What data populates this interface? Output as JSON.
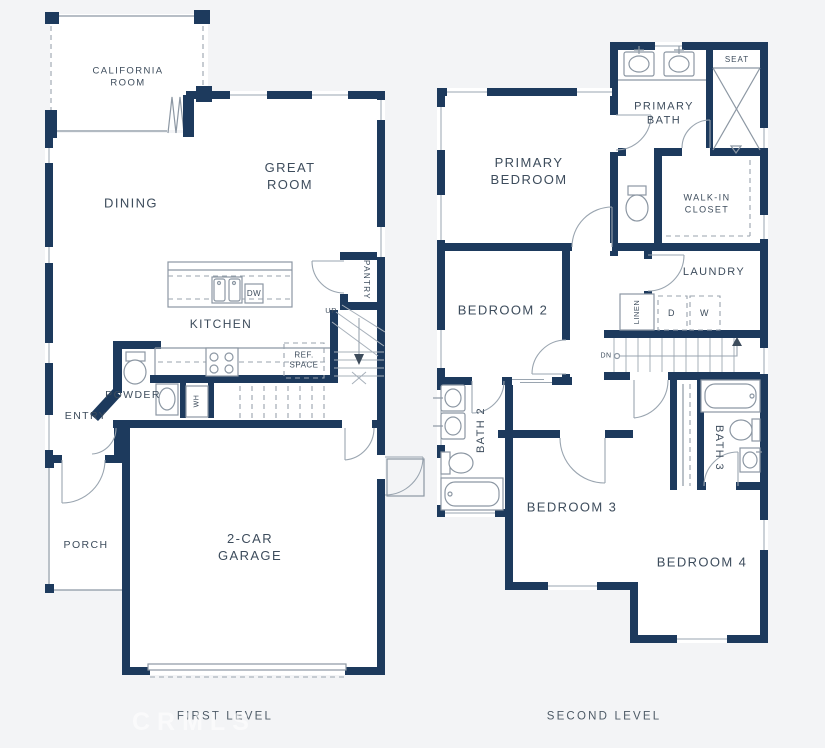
{
  "palette": {
    "wall": "#1d3a5d",
    "line": "#8c97a3",
    "text": "#3d4c5c",
    "background": "#f3f4f6"
  },
  "watermark": "CRMLS",
  "first_level": {
    "title": "FIRST LEVEL",
    "rooms": {
      "california_room": "CALIFORNIA\nROOM",
      "dining": "DINING",
      "great_room": "GREAT\nROOM",
      "kitchen": "KITCHEN",
      "pantry": "PANTRY",
      "powder": "POWDER",
      "entry": "ENTRY",
      "porch": "PORCH",
      "garage": "2-CAR\nGARAGE"
    },
    "annotations": {
      "up": "UP",
      "dishwasher": "DW",
      "ref_space": "REF.\nSPACE",
      "water_heater": "WH"
    }
  },
  "second_level": {
    "title": "SECOND LEVEL",
    "rooms": {
      "primary_bedroom": "PRIMARY\nBEDROOM",
      "primary_bath": "PRIMARY\nBATH",
      "walk_in_closet": "WALK-IN\nCLOSET",
      "laundry": "LAUNDRY",
      "bedroom_2": "BEDROOM 2",
      "bedroom_3": "BEDROOM 3",
      "bedroom_4": "BEDROOM 4",
      "bath_2": "BATH 2",
      "bath_3": "BATH 3"
    },
    "annotations": {
      "seat": "SEAT",
      "linen": "LINEN",
      "dryer": "D",
      "washer": "W",
      "down": "DN"
    }
  }
}
